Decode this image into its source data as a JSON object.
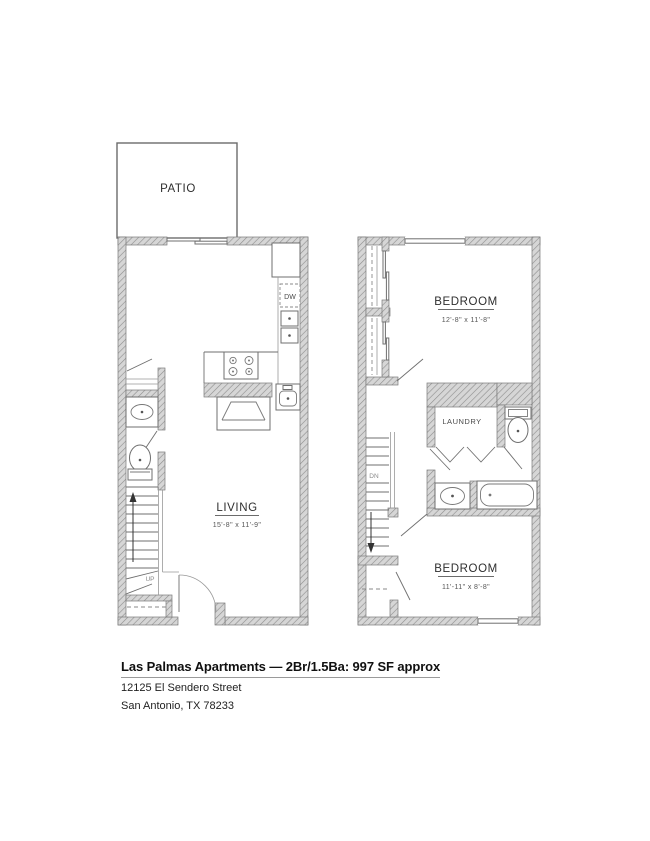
{
  "floorplan": {
    "patio_label": "PATIO",
    "living": {
      "label": "LIVING",
      "dims": "15'-8\" x 11'-9\""
    },
    "kitchen": {
      "dishwasher_label": "DW"
    },
    "stairs": {
      "up_label": "UP",
      "down_label": "DN"
    },
    "bedroom_upper": {
      "label": "BEDROOM",
      "dims": "12'-8\" x 11'-8\""
    },
    "bedroom_lower": {
      "label": "BEDROOM",
      "dims": "11'-11\" x 8'-8\""
    },
    "laundry_label": "LAUNDRY"
  },
  "caption": {
    "title": "Las Palmas Apartments — 2Br/1.5Ba: 997 SF approx",
    "address_line1": "12125 El Sendero Street",
    "address_line2": "San Antonio, TX 78233"
  },
  "colors": {
    "wall_fill": "#d6d6d6",
    "wall_hatch_line": "#8d8d8d",
    "line": "#6f6f6f",
    "text": "#2e2e2e"
  }
}
